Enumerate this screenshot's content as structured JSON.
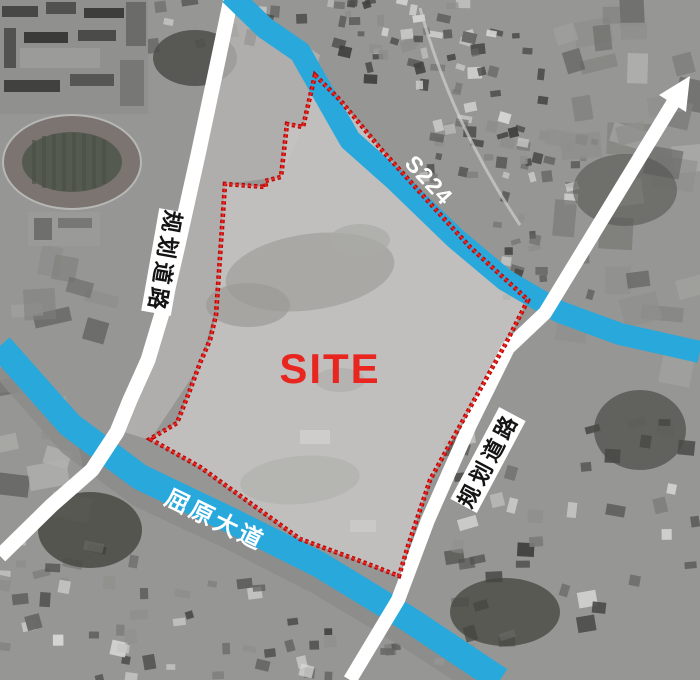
{
  "map": {
    "site_label": "SITE",
    "labels": {
      "s224": "S224",
      "quyuan_avenue": "屈原大道",
      "planned_road_left": "规划道路",
      "planned_road_right": "规划道路"
    },
    "colors": {
      "road_blue": "#29a8dc",
      "road_white": "#ffffff",
      "boundary_red_dark": "#b80808",
      "boundary_red_bright": "#e8251f",
      "site_text_red": "#e8251f",
      "label_black": "#141414",
      "site_fill_gray": "#c6c5c3"
    },
    "geometry": {
      "site_boundary_points": "315,75 340,100 380,148 427,200 470,247 528,300 505,345 477,395 430,480 408,546 399,576 360,561 300,539 200,467 150,439 177,423 190,390 200,363 210,340 216,315 220,257 225,184 266,187 265,181 281,177 287,124 303,127",
      "s224_points": "230,-6 265,28 300,52 350,140 395,180 455,238 505,280 560,312 620,334 700,352",
      "quyuan_points": "0,346 70,425 140,477 230,520 320,565 410,620 500,680",
      "quyuan_underlay_points": "0,368 68,446 138,498 228,540 318,586 408,640 492,695",
      "planned_road_left_points": "232,-6 215,75 198,155 178,245 163,310 148,360 130,400 117,432 92,470 52,505 0,556",
      "planned_road_right_points": "350,680 398,600 428,520 470,425 508,348 545,313 673,103",
      "arrow_head_points": "690,76 686,112 659,95"
    }
  }
}
